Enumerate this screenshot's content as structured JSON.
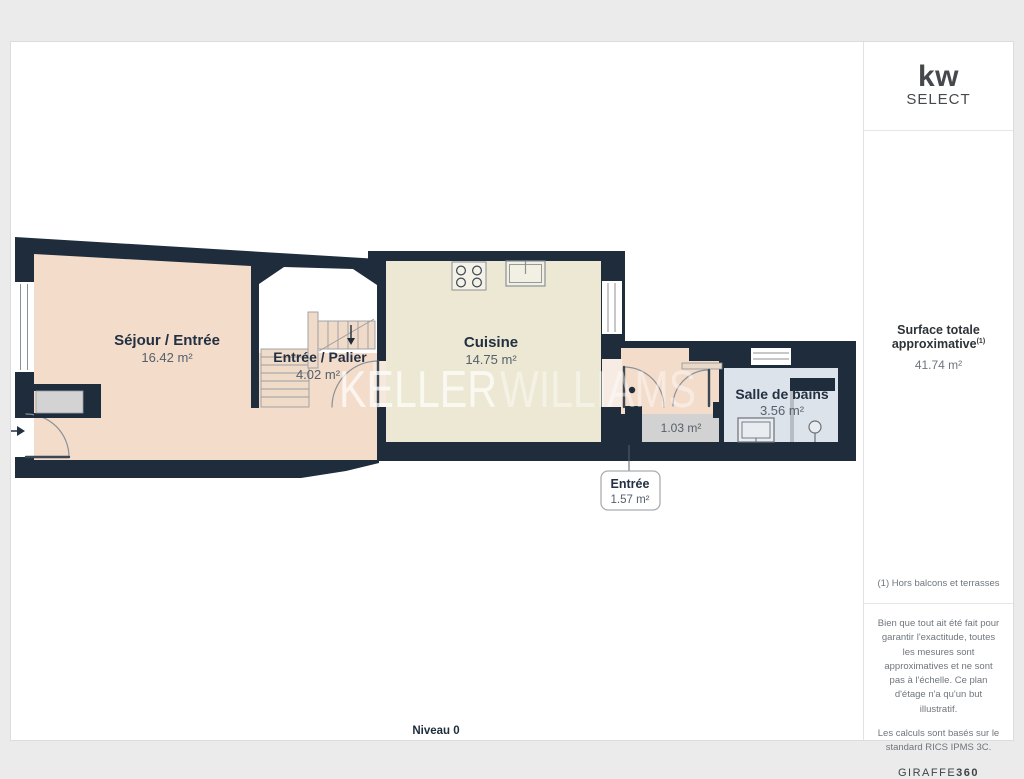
{
  "plan": {
    "level": "Niveau 0",
    "watermark": {
      "part1": "KELLER",
      "part2": "WILLIAMS"
    }
  },
  "rooms": {
    "sejour": {
      "name": "Séjour / Entrée",
      "area": "16.42 m²"
    },
    "palier": {
      "name": "Entrée / Palier",
      "area": "4.02 m²"
    },
    "cuisine": {
      "name": "Cuisine",
      "area": "14.75 m²"
    },
    "salle_de_bains": {
      "name": "Salle de bains",
      "area": "3.56 m²"
    },
    "wc": {
      "area": "1.03 m²"
    },
    "entree": {
      "name": "Entrée",
      "area": "1.57 m²"
    }
  },
  "sidebar": {
    "logo": {
      "line1": "kw",
      "line2": "SELECT"
    },
    "surface": {
      "label": "Surface totale approximative",
      "superscript": "(1)",
      "value": "41.74 m²"
    },
    "footnote": "(1) Hors balcons et terrasses",
    "disclaimer_1": "Bien que tout ait été fait pour garantir l'exactitude, toutes les mesures sont approximatives et ne sont pas à l'échelle. Ce plan d'étage n'a qu'un but illustratif.",
    "disclaimer_2": "Les calculs sont basés sur le standard RICS IPMS 3C.",
    "brand": {
      "regular": "GIRAFFE",
      "bold": "360"
    }
  },
  "colors": {
    "wall": "#1e2c3c",
    "sejour": "#f3dcca",
    "palier_floor": "#f3dcca",
    "palier_white": "#ffffff",
    "cuisine": "#ece8d3",
    "bathroom": "#dde3ea",
    "wc": "#d2d2d2",
    "closet": "#d3d3d3",
    "stairs": "#f0dac8",
    "vestibule": "#f3dcca"
  }
}
